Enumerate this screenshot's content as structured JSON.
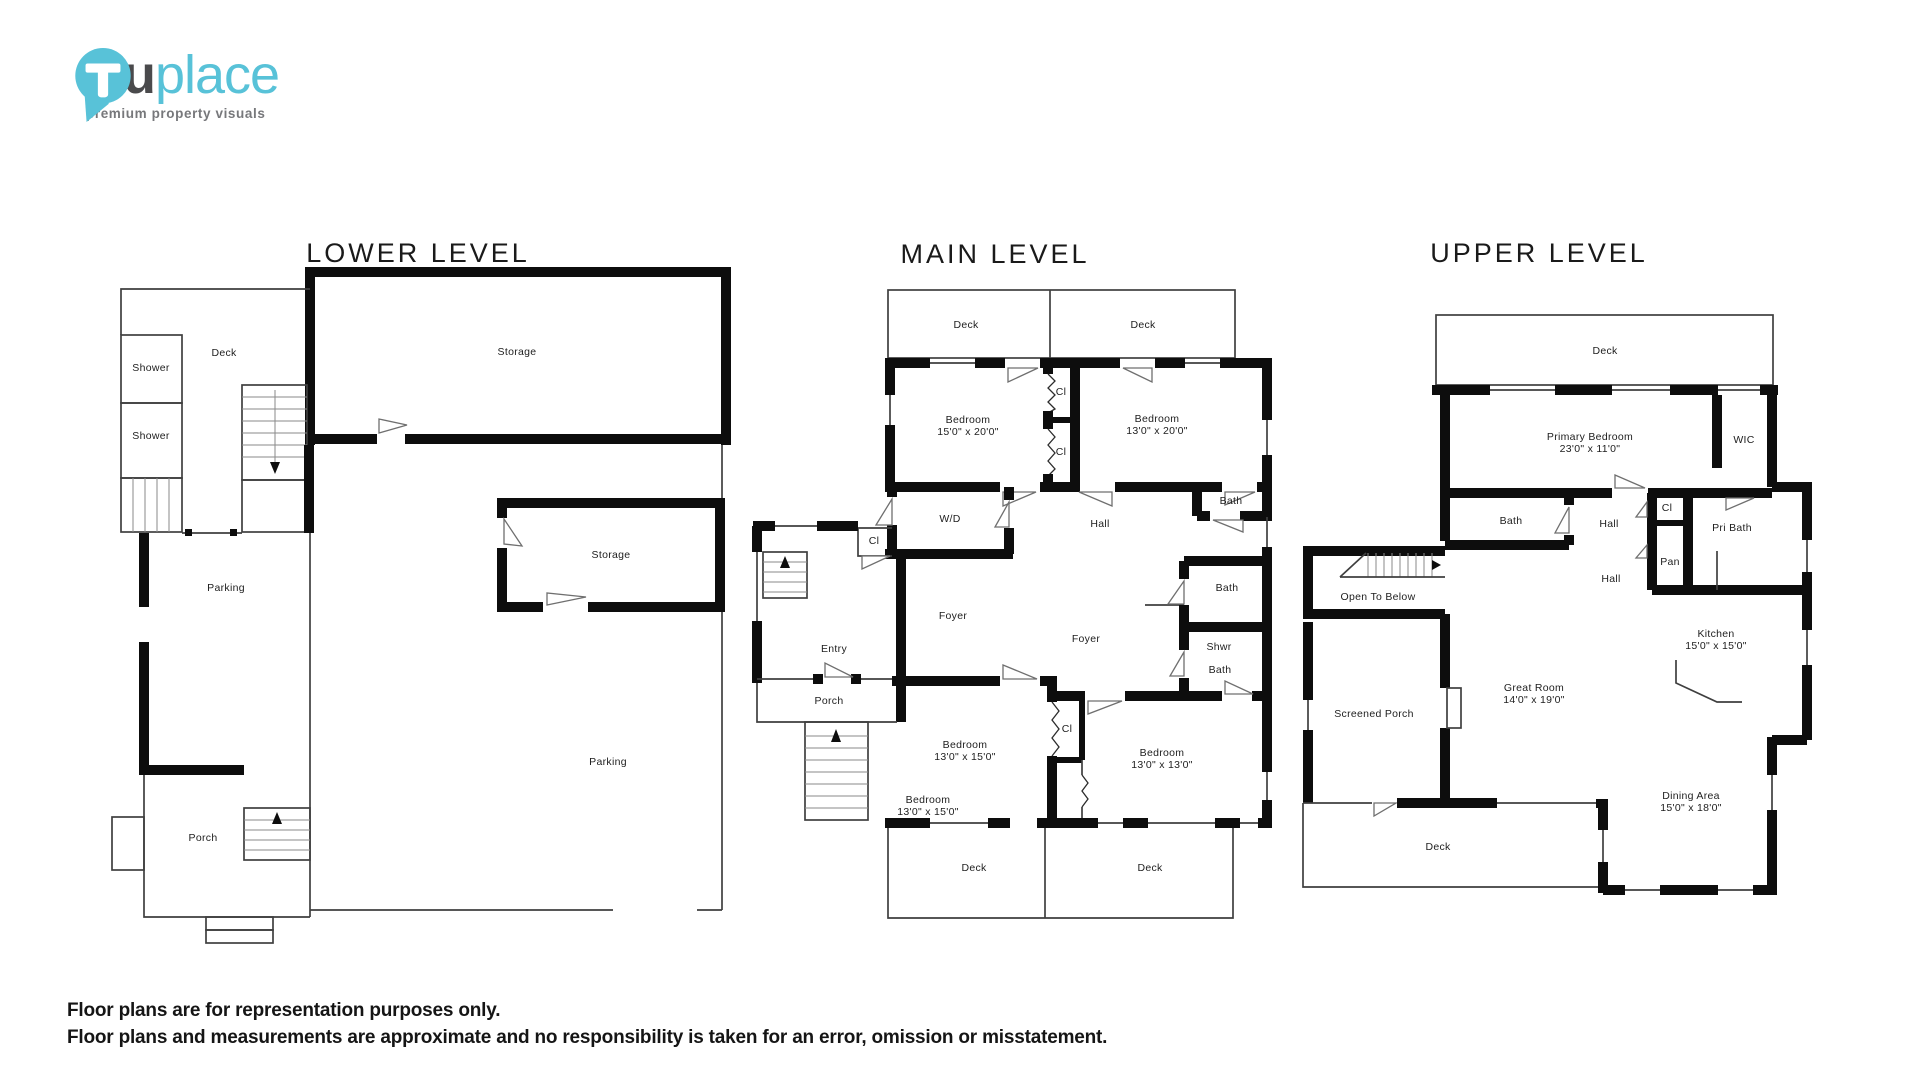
{
  "logo": {
    "brand_bold": "tru",
    "brand_light": "place",
    "tagline": "premium property visuals",
    "icon": "truplace-pin-icon",
    "colors": {
      "teal": "#58c2d8",
      "dark_gray": "#4a4a4c",
      "tagline_gray": "#77787b",
      "wall_black": "#0d0d0d"
    }
  },
  "plans": {
    "lower": {
      "title": "LOWER LEVEL",
      "rooms": {
        "deck": "Deck",
        "shower1": "Shower",
        "shower2": "Shower",
        "storage1": "Storage",
        "storage2": "Storage",
        "parking1": "Parking",
        "parking2": "Parking",
        "porch": "Porch"
      }
    },
    "main": {
      "title": "MAIN LEVEL",
      "rooms": {
        "deck_tl": "Deck",
        "deck_tr": "Deck",
        "bedroom1": "Bedroom",
        "bedroom1_dim": "15'0\" x 20'0\"",
        "bedroom2": "Bedroom",
        "bedroom2_dim": "13'0\" x 20'0\"",
        "cl1": "Cl",
        "cl2": "Cl",
        "bath1": "Bath",
        "wd": "W/D",
        "hall": "Hall",
        "cl3": "Cl",
        "foyer1": "Foyer",
        "foyer2": "Foyer",
        "bath2": "Bath",
        "shwr": "Shwr",
        "bath3": "Bath",
        "entry": "Entry",
        "porch": "Porch",
        "bedroom3": "Bedroom",
        "bedroom3_dim": "13'0\" x 15'0\"",
        "bedroom4": "Bedroom",
        "bedroom4_dim": "13'0\" x 13'0\"",
        "bedroom5": "Bedroom",
        "bedroom5_dim": "13'0\" x 15'0\"",
        "cl4": "Cl",
        "deck_bl": "Deck",
        "deck_br": "Deck"
      }
    },
    "upper": {
      "title": "UPPER LEVEL",
      "rooms": {
        "deck_top": "Deck",
        "primary": "Primary Bedroom",
        "primary_dim": "23'0\" x 11'0\"",
        "wic": "WIC",
        "bath": "Bath",
        "hall1": "Hall",
        "cl": "Cl",
        "pri_bath": "Pri Bath",
        "pan": "Pan",
        "hall2": "Hall",
        "open_below": "Open To Below",
        "kitchen": "Kitchen",
        "kitchen_dim": "15'0\" x 15'0\"",
        "great": "Great Room",
        "great_dim": "14'0\" x 19'0\"",
        "screened": "Screened Porch",
        "deck_bottom": "Deck",
        "dining": "Dining Area",
        "dining_dim": "15'0\" x 18'0\""
      }
    }
  },
  "disclaimer": {
    "line1": "Floor plans are for representation purposes only.",
    "line2": "Floor plans and measurements are approximate and no responsibility is taken for an error, omission or misstatement."
  }
}
